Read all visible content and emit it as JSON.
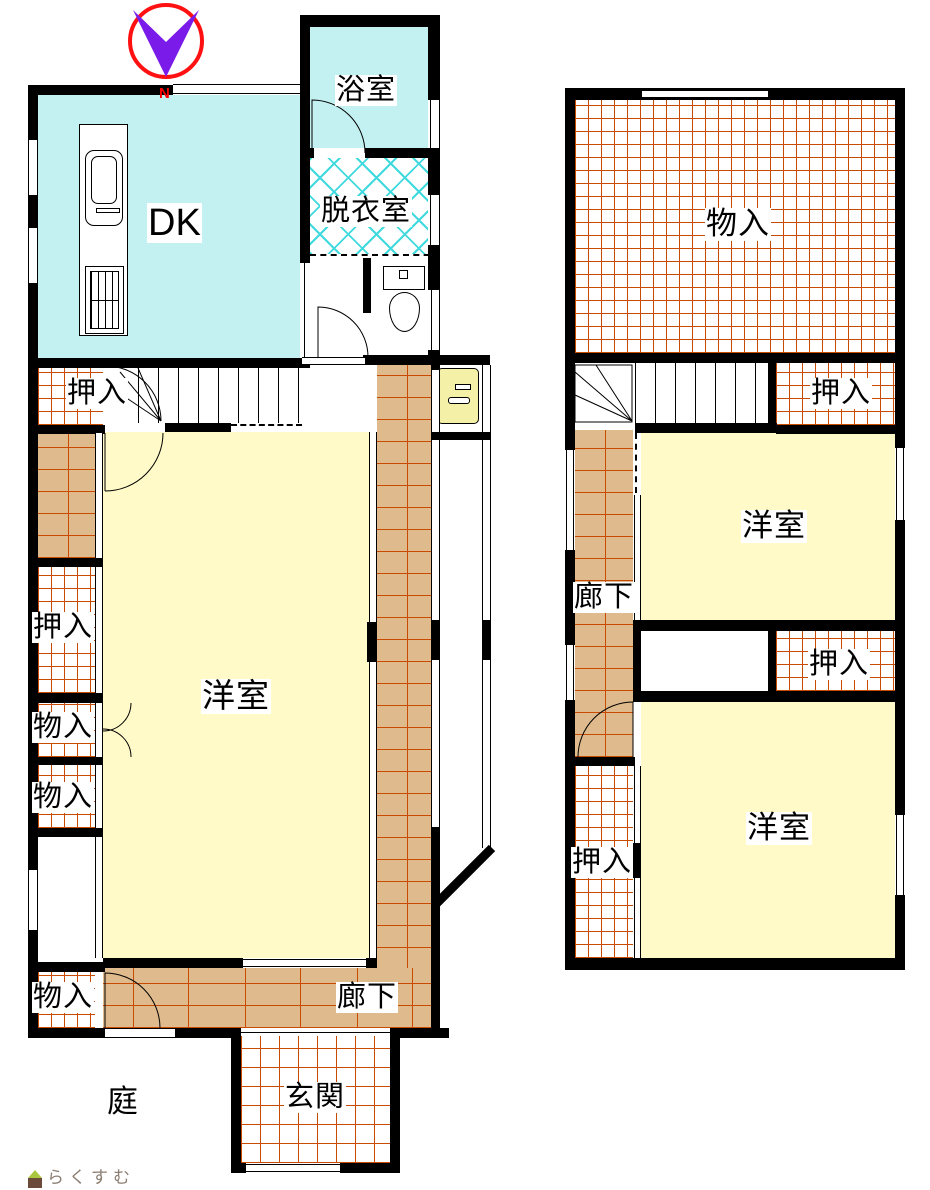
{
  "compass": {
    "north_label": "N"
  },
  "floor1": {
    "rooms": {
      "dk": "DK",
      "bathroom": "浴室",
      "dressing_room": "脱衣室",
      "closet_upper": "押入",
      "western_room": "洋室",
      "closet_left": "押入",
      "storage_1": "物入",
      "storage_2": "物入",
      "storage_3": "物入",
      "corridor": "廊下",
      "entrance": "玄関",
      "garden": "庭"
    }
  },
  "floor2": {
    "rooms": {
      "storage": "物入",
      "closet_upper": "押入",
      "western_room_upper": "洋室",
      "corridor": "廊下",
      "closet_middle": "押入",
      "western_room_lower": "洋室",
      "closet_lower": "押入"
    }
  },
  "watermark": {
    "brand": "らくすむ"
  },
  "colors": {
    "room_cyan": "#c3f1f2",
    "room_yellow": "#fffac8",
    "floor_tan": "#dfba8c",
    "line_brick": "#c84b00",
    "hatch_cyan": "#3fd9de",
    "wall_black": "#000000",
    "compass_red": "#ff1111",
    "compass_purple": "#7a1be9",
    "north_red": "#ff0000",
    "basin_yellow": "#f5f0a8",
    "logo_green": "#a9c83f",
    "logo_brown": "#6b4a3a",
    "logo_text": "#8b7d72"
  }
}
